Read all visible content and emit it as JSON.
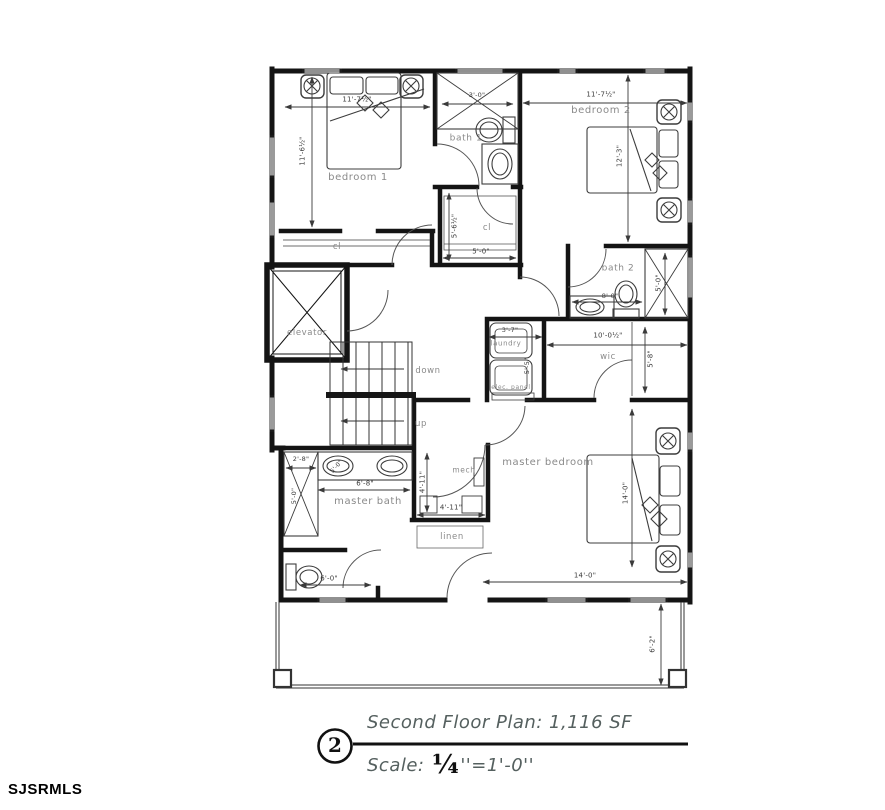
{
  "drawing": {
    "number": "2",
    "title": "Second Floor Plan: 1,116 SF",
    "scale_label": "Scale:",
    "scale_fraction": "¼",
    "scale_rest": "''=1'-0''",
    "watermark": "SJSRMLS"
  },
  "colors": {
    "walls": "#141414",
    "annotation_gray": "#8a8a8a",
    "dim_text": "#3b3b3b"
  },
  "rooms": [
    {
      "n": "bedroom-1",
      "t": "bedroom 1",
      "x": 358,
      "y": 178,
      "s": 10
    },
    {
      "n": "bath-1",
      "t": "bath 1",
      "x": 466,
      "y": 139,
      "s": 9
    },
    {
      "n": "bedroom-2",
      "t": "bedroom 2",
      "x": 601,
      "y": 111,
      "s": 10
    },
    {
      "n": "bath-2",
      "t": "bath 2",
      "x": 618,
      "y": 269,
      "s": 9
    },
    {
      "n": "closet-bedroom-1",
      "t": "cl",
      "x": 337,
      "y": 247,
      "s": 8.5
    },
    {
      "n": "closet-hall",
      "t": "cl",
      "x": 487,
      "y": 228,
      "s": 8.5
    },
    {
      "n": "elevator",
      "t": "elevator",
      "x": 307,
      "y": 333,
      "s": 8.5
    },
    {
      "n": "stair-down",
      "t": "down",
      "x": 428,
      "y": 371,
      "s": 8.5
    },
    {
      "n": "stair-up",
      "t": "up",
      "x": 421,
      "y": 424,
      "s": 8.5
    },
    {
      "n": "laundry",
      "t": "laundry",
      "x": 506,
      "y": 344,
      "s": 7
    },
    {
      "n": "elec-panel",
      "t": "elec. panel",
      "x": 511,
      "y": 388,
      "s": 6
    },
    {
      "n": "wic",
      "t": "wic",
      "x": 608,
      "y": 357,
      "s": 8.5
    },
    {
      "n": "master-bedroom",
      "t": "master bedroom",
      "x": 548,
      "y": 463,
      "s": 10
    },
    {
      "n": "master-bath",
      "t": "master bath",
      "x": 368,
      "y": 502,
      "s": 10
    },
    {
      "n": "mech",
      "t": "mech",
      "x": 464,
      "y": 470,
      "s": 7.5
    },
    {
      "n": "linen",
      "t": "linen",
      "x": 452,
      "y": 537,
      "s": 8.5
    }
  ],
  "dimensions": [
    {
      "n": "bedroom1-width",
      "t": "11'-7½\"",
      "x": 357,
      "y": 100,
      "s": 7
    },
    {
      "n": "bedroom1-depth",
      "t": "11'-6½\"",
      "x": 303,
      "y": 151,
      "s": 7,
      "r": -90
    },
    {
      "n": "bath1-shower",
      "t": "3'-0\"",
      "x": 477,
      "y": 95,
      "s": 6.5
    },
    {
      "n": "bedroom2-width",
      "t": "11'-7½\"",
      "x": 601,
      "y": 95,
      "s": 7
    },
    {
      "n": "bedroom2-depth",
      "t": "12'-3\"",
      "x": 620,
      "y": 156,
      "s": 7,
      "r": -90
    },
    {
      "n": "hall-closet-depth",
      "t": "5'-6½\"",
      "x": 455,
      "y": 226,
      "s": 7,
      "r": -90
    },
    {
      "n": "hall-closet-width",
      "t": "5'-0\"",
      "x": 481,
      "y": 252,
      "s": 7
    },
    {
      "n": "bath2-width",
      "t": "8'-0\"",
      "x": 610,
      "y": 296,
      "s": 6.5
    },
    {
      "n": "bath2-shower",
      "t": "5'-0\"",
      "x": 659,
      "y": 283,
      "s": 7,
      "r": -90
    },
    {
      "n": "wic-width",
      "t": "10'-0½\"",
      "x": 608,
      "y": 336,
      "s": 7
    },
    {
      "n": "laundry-width",
      "t": "3'-7\"",
      "x": 510,
      "y": 330,
      "s": 6.5
    },
    {
      "n": "laundry-depth",
      "t": "5'-5\"",
      "x": 527,
      "y": 366,
      "s": 6.5,
      "r": -90
    },
    {
      "n": "wic-depth",
      "t": "5'-8\"",
      "x": 651,
      "y": 359,
      "s": 7,
      "r": -90
    },
    {
      "n": "mbath-shower-width",
      "t": "2'-8\"",
      "x": 301,
      "y": 459,
      "s": 6.5
    },
    {
      "n": "mbath-shower-depth",
      "t": "5'-0\"",
      "x": 294,
      "y": 496,
      "s": 6.5,
      "r": -90
    },
    {
      "n": "mbath-sink",
      "t": "5'-0\"",
      "x": 337,
      "y": 467,
      "s": 6,
      "r": -48
    },
    {
      "n": "mbath-vanity",
      "t": "6'-8\"",
      "x": 365,
      "y": 484,
      "s": 7
    },
    {
      "n": "mech-depth",
      "t": "4'-11\"",
      "x": 423,
      "y": 482,
      "s": 7,
      "r": -90
    },
    {
      "n": "mech-width",
      "t": "4'-11\"",
      "x": 451,
      "y": 508,
      "s": 7
    },
    {
      "n": "toilet-room-width",
      "t": "6'-0\"",
      "x": 329,
      "y": 579,
      "s": 7
    },
    {
      "n": "master-depth",
      "t": "14'-0\"",
      "x": 626,
      "y": 493,
      "s": 7,
      "r": -90
    },
    {
      "n": "master-width",
      "t": "14'-0\"",
      "x": 585,
      "y": 576,
      "s": 7
    },
    {
      "n": "deck-depth",
      "t": "6'-2\"",
      "x": 653,
      "y": 644,
      "s": 7,
      "r": -90
    }
  ]
}
